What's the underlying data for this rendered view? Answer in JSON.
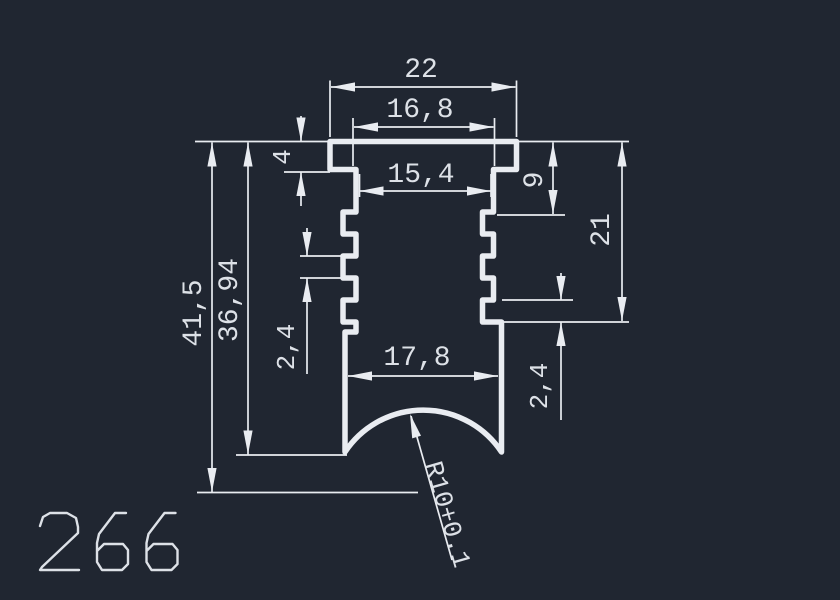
{
  "drawing": {
    "profile_number": "266",
    "colors": {
      "background": "#202631",
      "line": "#e9ecf1",
      "text": "#dde1e7"
    },
    "dims": {
      "overall_width": "22",
      "cap_width": "16,8",
      "neck_width": "15,4",
      "inner_width": "17,8",
      "overall_height": "41,5",
      "inner_height": "36,94",
      "cap_height": "4",
      "serration_pitch_left": "2,4",
      "serration_pitch_right": "2,4",
      "neck_depth": "9",
      "serration_depth": "21",
      "bottom_radius": "R10+0.1"
    }
  }
}
